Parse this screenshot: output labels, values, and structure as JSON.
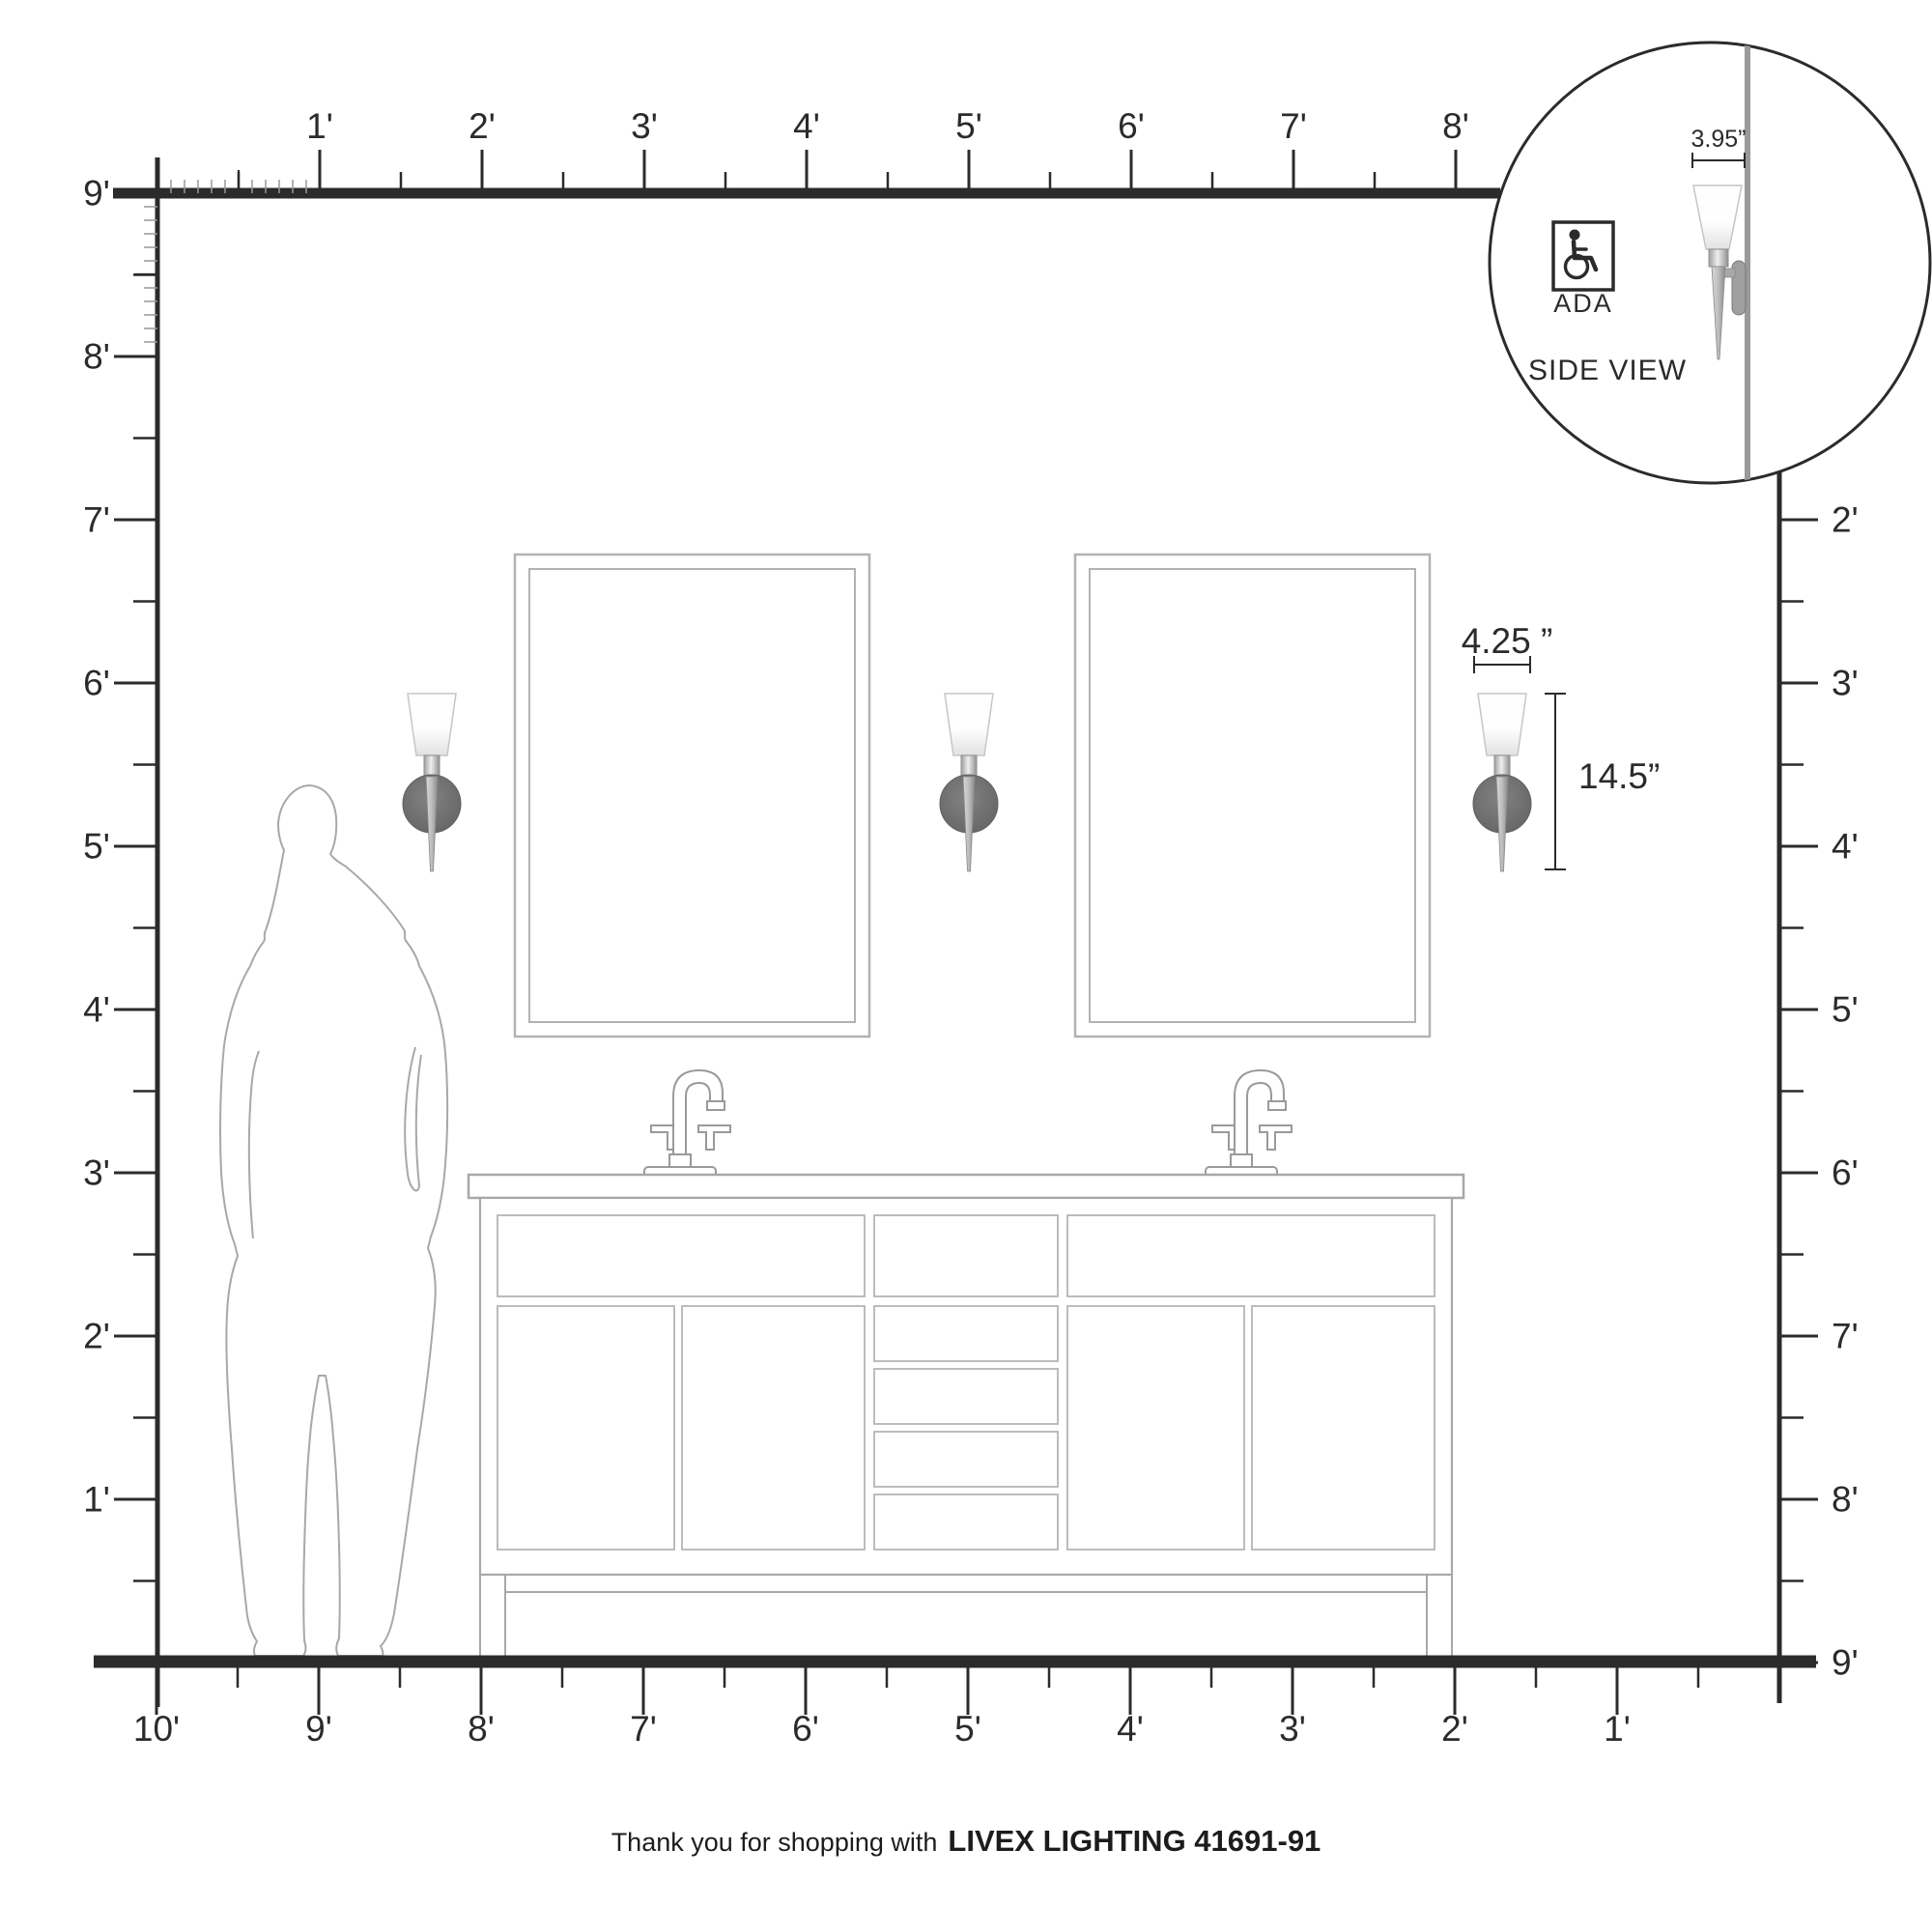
{
  "rulers": {
    "top": [
      "1'",
      "2'",
      "3'",
      "4'",
      "5'",
      "6'",
      "7'",
      "8'"
    ],
    "left": [
      "9'",
      "8'",
      "7'",
      "6'",
      "5'",
      "4'",
      "3'",
      "2'",
      "1'"
    ],
    "right": [
      "2'",
      "3'",
      "4'",
      "5'",
      "6'",
      "7'",
      "8'",
      "9'"
    ],
    "bottom": [
      "10'",
      "9'",
      "8'",
      "7'",
      "6'",
      "5'",
      "4'",
      "3'",
      "2'",
      "1'"
    ]
  },
  "annotations": {
    "fixture_width": "4.25 ”",
    "fixture_height": "14.5”"
  },
  "inset": {
    "depth": "3.95”",
    "ada": "ADA",
    "caption": "SIDE VIEW"
  },
  "footer": {
    "prefix": "Thank you for shopping with",
    "brand": "LIVEX LIGHTING 41691-91"
  },
  "colors": {
    "ink": "#2b2b2b",
    "outline": "#a8a8a8",
    "minor_tick": "#999999",
    "wall_gray": "#9a9a9a",
    "backplate": "#6e6e6e"
  }
}
